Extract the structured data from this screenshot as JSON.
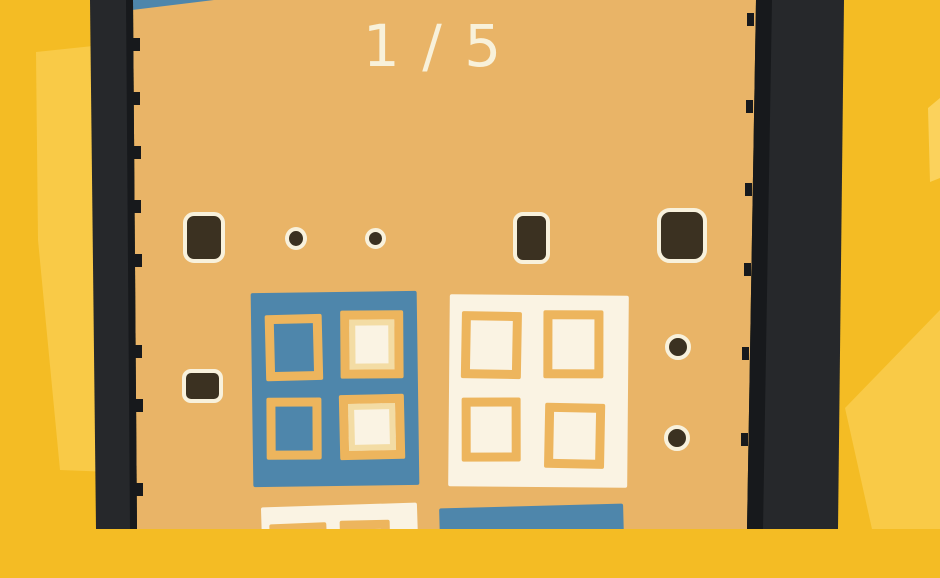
{
  "hud": {
    "progress": "1 / 5"
  },
  "colors": {
    "bg_yellow": "#f4bc24",
    "bg_yellow_light": "#f9ca47",
    "bg_yellow_lighter": "#fbd25c",
    "bezel_dark": "#26282b",
    "bezel_edge": "#17191c",
    "screen_tan": "#e9b467",
    "peg_dark": "#3b3121",
    "peg_outline": "#f8f1dc",
    "tile_blue": "#4e86ab",
    "tile_cream": "#faf3e3",
    "cell_frame_orange": "#edb55d",
    "cell_rim_light": "#f3dca4",
    "text_cream": "#f8f1da"
  },
  "board": {
    "pegs": [
      {
        "shape": "square",
        "x": 183,
        "y": 212,
        "w": 34,
        "h": 43,
        "r": 11
      },
      {
        "shape": "dot",
        "x": 285,
        "y": 227,
        "w": 14,
        "h": 15
      },
      {
        "shape": "dot",
        "x": 365,
        "y": 228,
        "w": 13,
        "h": 13
      },
      {
        "shape": "tall-rect",
        "x": 513,
        "y": 212,
        "w": 29,
        "h": 44,
        "r": 10
      },
      {
        "shape": "square",
        "x": 657,
        "y": 208,
        "w": 42,
        "h": 47,
        "r": 13
      },
      {
        "shape": "wide-rect",
        "x": 182,
        "y": 369,
        "w": 33,
        "h": 26,
        "r": 9
      },
      {
        "shape": "dot",
        "x": 665,
        "y": 334,
        "w": 18,
        "h": 18
      },
      {
        "shape": "dot",
        "x": 664,
        "y": 425,
        "w": 18,
        "h": 18
      }
    ],
    "tiles": [
      {
        "base": "blue",
        "x": 252,
        "y": 292,
        "w": 166,
        "h": 194,
        "rot": -0.8,
        "cells": [
          {
            "x": 14,
            "y": 22,
            "w": 57,
            "h": 66,
            "fill": "blue",
            "rot": -0.6
          },
          {
            "x": 89,
            "y": 19,
            "w": 63,
            "h": 68,
            "fill": "cream",
            "rim": true,
            "rot": 0.4
          },
          {
            "x": 14,
            "y": 105,
            "w": 55,
            "h": 62,
            "fill": "blue",
            "rot": 0.5
          },
          {
            "x": 87,
            "y": 103,
            "w": 65,
            "h": 65,
            "fill": "cream",
            "rim": true,
            "rot": -0.5
          }
        ]
      },
      {
        "base": "cream",
        "x": 449,
        "y": 295,
        "w": 179,
        "h": 192,
        "rot": 0.5,
        "cells": [
          {
            "x": 12,
            "y": 17,
            "w": 60,
            "h": 67,
            "fill": "cream",
            "rot": 0.5
          },
          {
            "x": 94,
            "y": 15,
            "w": 60,
            "h": 68,
            "fill": "cream",
            "rot": -0.4
          },
          {
            "x": 13,
            "y": 103,
            "w": 59,
            "h": 64,
            "fill": "cream",
            "rot": -0.6
          },
          {
            "x": 96,
            "y": 108,
            "w": 60,
            "h": 65,
            "fill": "cream",
            "rot": 0.6
          }
        ]
      },
      {
        "base": "cream",
        "x": 262,
        "y": 505,
        "w": 156,
        "h": 70,
        "rot": -1.8,
        "cells": [
          {
            "x": 8,
            "y": 17,
            "w": 57,
            "h": 50,
            "fill": "cream",
            "rot": -0.5
          },
          {
            "x": 78,
            "y": 16,
            "w": 50,
            "h": 50,
            "fill": "cream",
            "rot": 0.5
          }
        ]
      },
      {
        "base": "blue",
        "x": 440,
        "y": 506,
        "w": 184,
        "h": 70,
        "rot": -1.5,
        "cells": []
      }
    ]
  }
}
